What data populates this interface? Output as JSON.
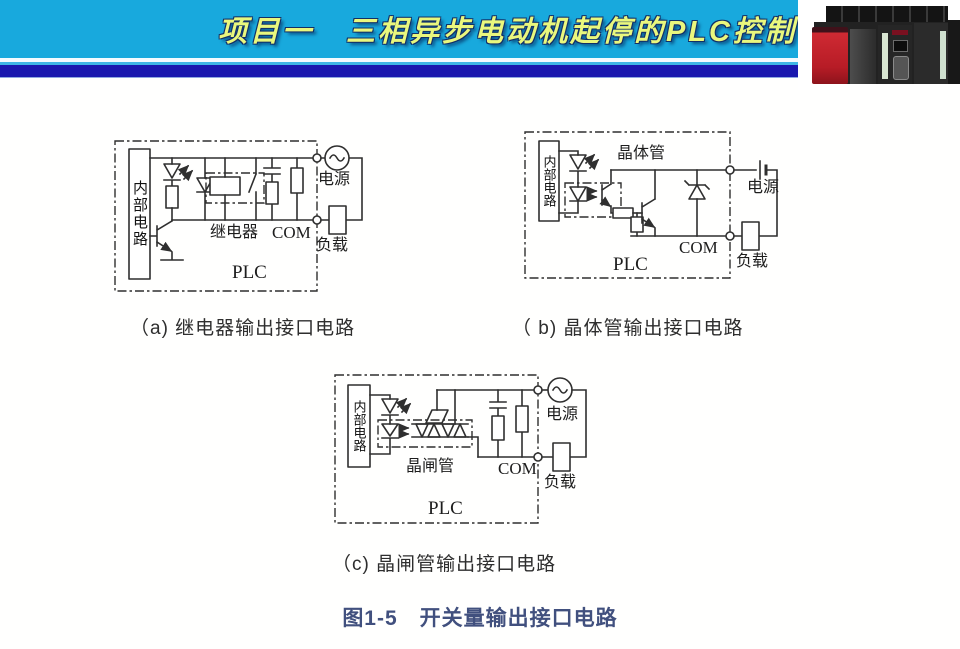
{
  "header": {
    "title": "项目一　三相异步电动机起停的PLC控制",
    "bg_color": "#18a9dd",
    "bar_color": "#1a18ae",
    "title_color": "#e9f77d"
  },
  "circuits": {
    "a": {
      "caption": "（a) 继电器输出接口电路",
      "labels": {
        "internal": "内部电路",
        "device": "继电器",
        "com": "COM",
        "plc": "PLC",
        "power": "电源",
        "load": "负载"
      }
    },
    "b": {
      "caption": "（ b) 晶体管输出接口电路",
      "labels": {
        "internal": "内部电路",
        "device": "晶体管",
        "com": "COM",
        "plc": "PLC",
        "power": "电源",
        "load": "负载"
      }
    },
    "c": {
      "caption": "（c) 晶闸管输出接口电路",
      "labels": {
        "internal": "内部电路",
        "device": "晶闸管",
        "com": "COM",
        "plc": "PLC",
        "power": "电源",
        "load": "负载"
      }
    }
  },
  "figure": {
    "caption": "图1-5　开关量输出接口电路",
    "color": "#41507e"
  }
}
